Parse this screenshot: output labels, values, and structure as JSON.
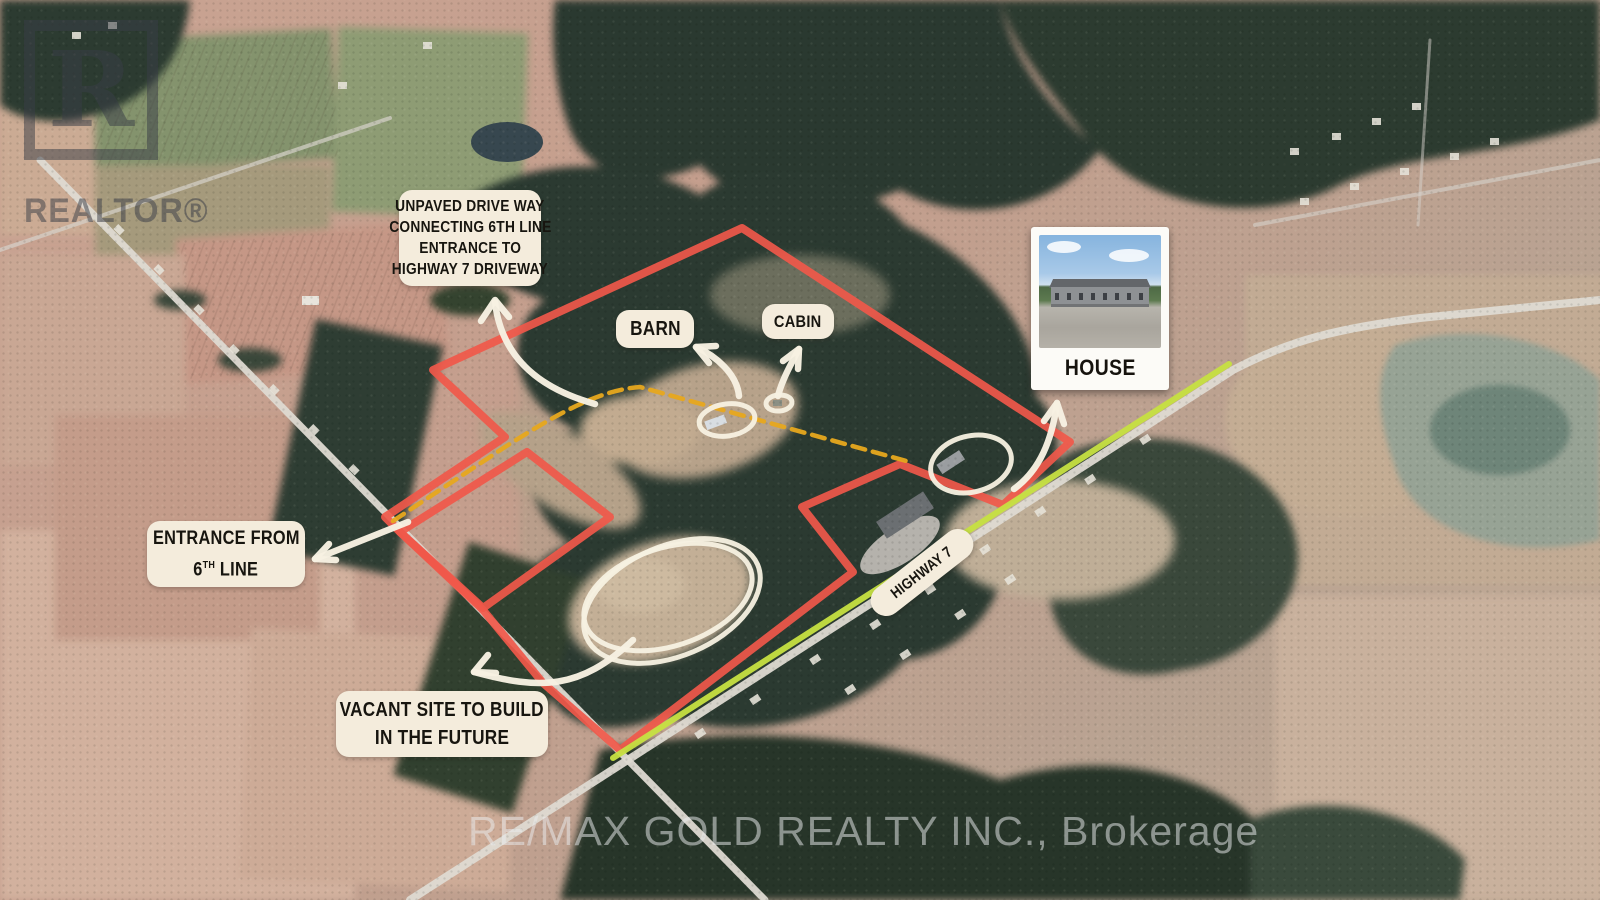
{
  "colors": {
    "boundary": "#f0584a",
    "driveway": "#e7a81e",
    "highway_line": "#c6e041",
    "label_bg": "#f4ecdc",
    "label_text": "#17150f",
    "annotation": "#f7f1e2",
    "watermark": "rgba(233,236,238,0.52)",
    "logo": "rgba(58,62,72,0.58)"
  },
  "watermarks": {
    "logo_letter": "R",
    "logo_text": "REALTOR®",
    "brokerage": "RE/MAX GOLD REALTY INC., Brokerage"
  },
  "labels": {
    "unpaved": {
      "lines": [
        "UNPAVED DRIVE WAY",
        "CONNECTING 6TH LINE",
        "ENTRANCE TO",
        "HIGHWAY 7 DRIVEWAY"
      ]
    },
    "barn": "BARN",
    "cabin": "CABIN",
    "house_caption": "HOUSE",
    "entrance": {
      "line1": "ENTRANCE FROM",
      "line2_pre": "6",
      "line2_sup": "TH",
      "line2_post": " LINE"
    },
    "vacant": {
      "lines": [
        "VACANT SITE TO BUILD",
        "IN THE FUTURE"
      ]
    },
    "highway": "HIGHWAY 7"
  }
}
